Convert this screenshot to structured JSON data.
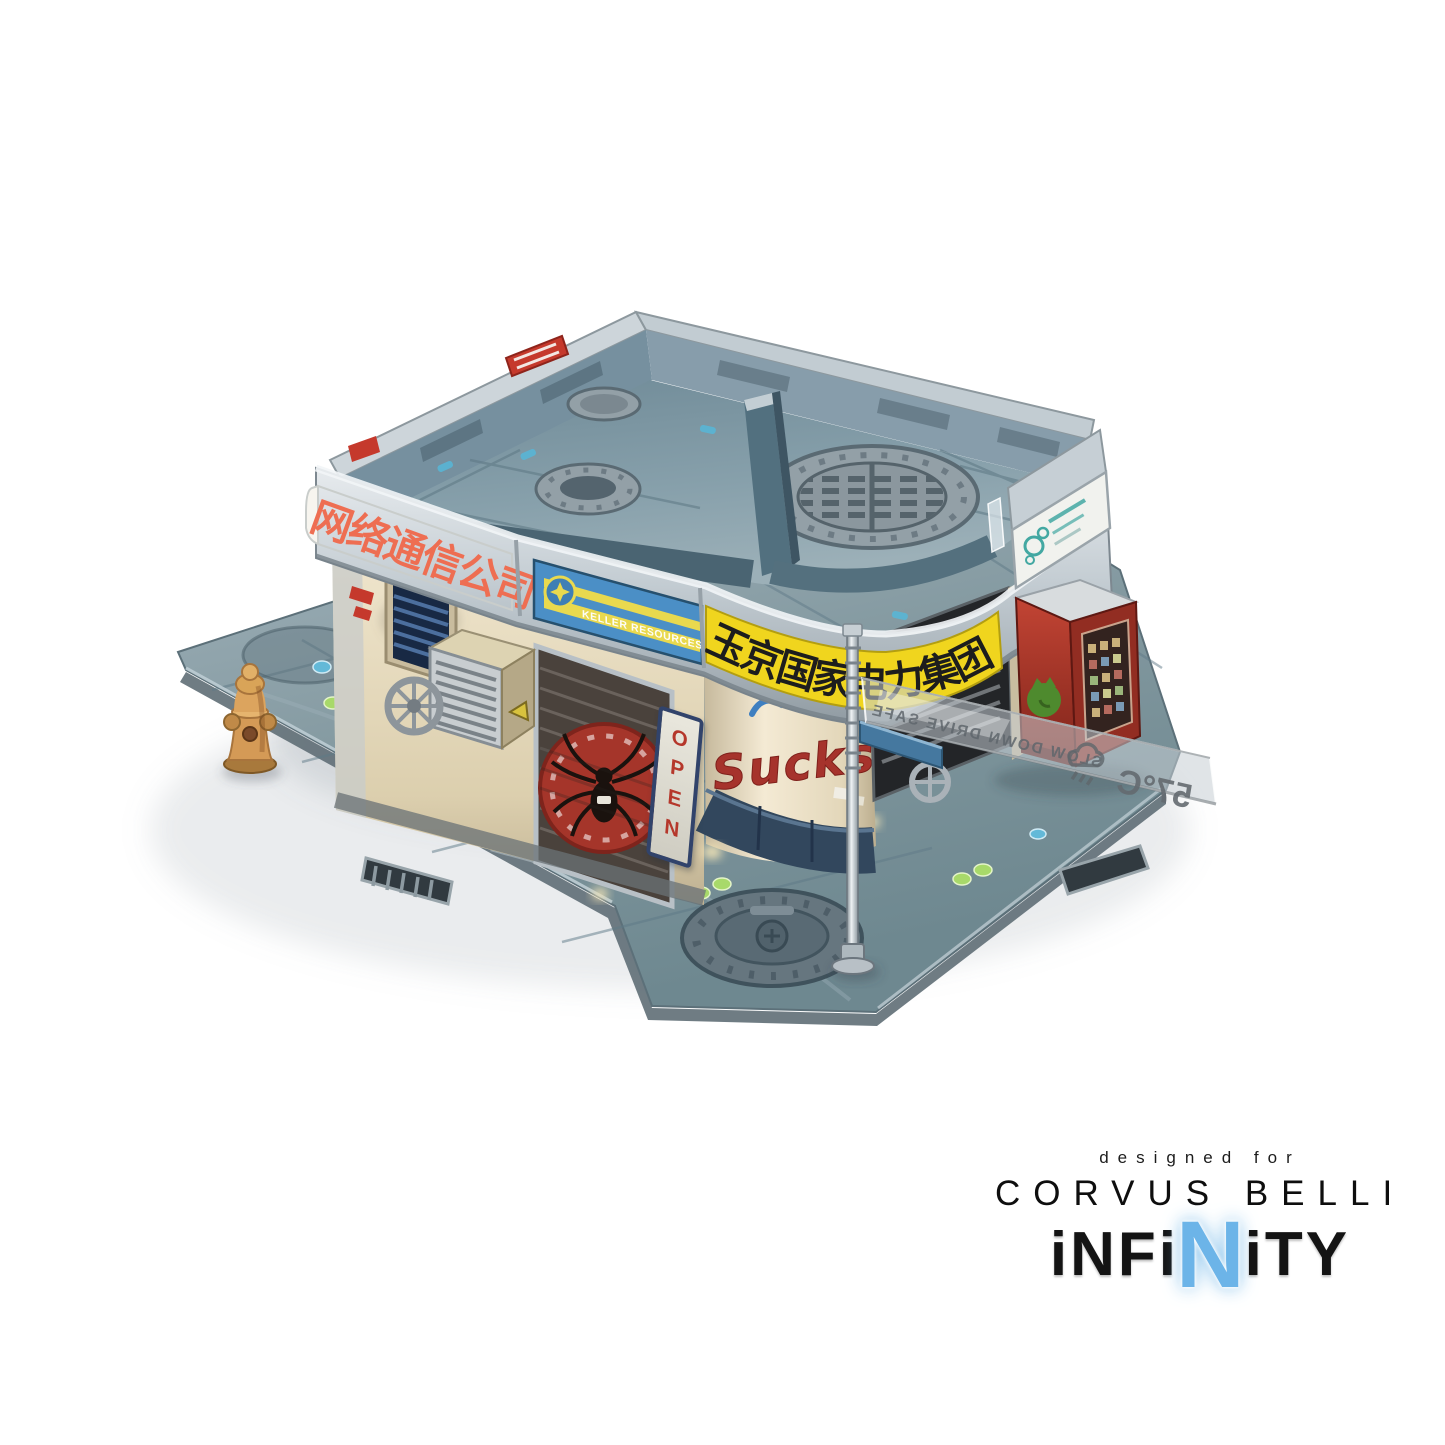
{
  "signs": {
    "telecom_banner": "网络通信公司",
    "power_banner": "玉京国家电力集团",
    "keller_sign": "KELLER RESOURCES GROUP",
    "open_sign": "OPEN",
    "graffiti": "Sucks",
    "street_sign_warning": "SLOW DOWN DRIVE SAFE",
    "street_sign_temperature": "57°C"
  },
  "branding": {
    "designed_for": "designed for",
    "company": "CORVUS BELLI",
    "logo_prefix": "iNFi",
    "logo_mid": "N",
    "logo_suffix": "iTY"
  },
  "colors": {
    "background": "#ffffff",
    "telecom_text_red": "#ee6e52",
    "power_banner_yellow": "#f0d51e",
    "keller_blue": "#4b8fc6",
    "keller_stripe_yellow": "#e9d94e",
    "roof_slate": "#7d98a6",
    "wall_cream": "#e9dfc6",
    "street_grey": "#7d949e",
    "vending_machine_red": "#b23527",
    "hydrant_tan": "#d49a56",
    "spider_sign_red": "#a5352a",
    "infinity_blue": "#6cb4e8",
    "chrome_silver": "#ccd4d9"
  }
}
